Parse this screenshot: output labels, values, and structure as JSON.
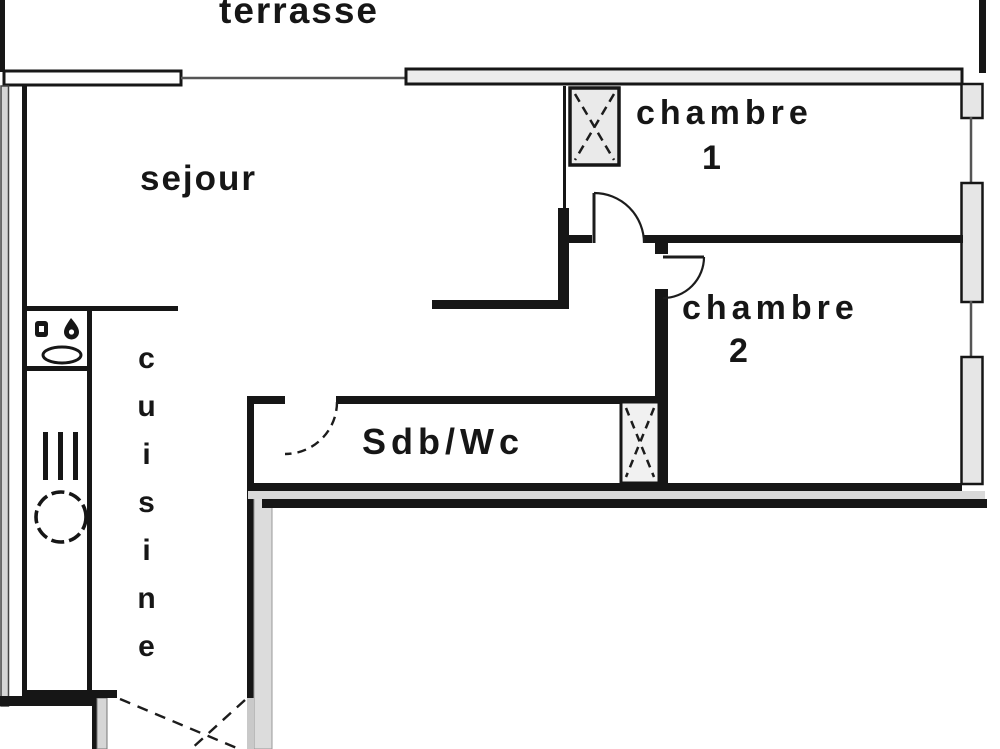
{
  "floorplan": {
    "rooms": {
      "terrasse": {
        "label": "terrasse"
      },
      "sejour": {
        "label": "sejour"
      },
      "chambre1": {
        "label": "chambre",
        "number": "1"
      },
      "chambre2": {
        "label": "chambre",
        "number": "2"
      },
      "sdb_wc": {
        "label": "Sdb/Wc"
      },
      "cuisine": {
        "label": "cuisine"
      }
    },
    "colors": {
      "line": "#161616",
      "wall_cavity_fill": "#d9d9d9",
      "pier_fill": "#e6e6e6",
      "background": "#ffffff",
      "text": "#161616"
    },
    "symbols": {
      "shaft_icon": "x-crossed-box",
      "door_swing_icon": "quarter-arc",
      "entrance_swing_icon": "dashed-cross",
      "window_icon": "thin-double-line"
    }
  }
}
